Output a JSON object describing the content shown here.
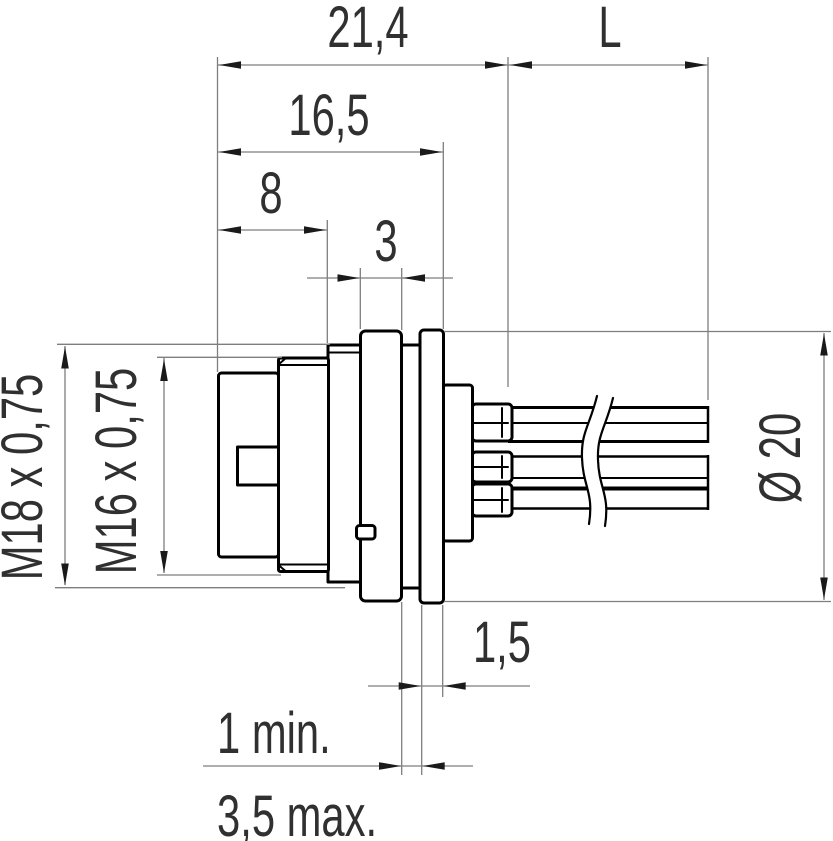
{
  "drawing_type": "connector-technical-drawing",
  "colors": {
    "background": "#ffffff",
    "part_outline": "#000000",
    "dimension_line": "#7e7e7e",
    "text": "#303030"
  },
  "dims": {
    "overall_depth": {
      "label": "21,4",
      "orientation": "horizontal"
    },
    "wire_length": {
      "label": "L",
      "orientation": "horizontal"
    },
    "front_depth": {
      "label": "16,5",
      "orientation": "horizontal"
    },
    "thread_depth": {
      "label": "8",
      "orientation": "horizontal"
    },
    "flange_thickness": {
      "label": "3",
      "orientation": "horizontal"
    },
    "disc_thickness": {
      "label": "1,5",
      "orientation": "horizontal"
    },
    "panel_min": {
      "label": "1 min.",
      "orientation": "horizontal"
    },
    "panel_max": {
      "label": "3,5 max.",
      "orientation": "horizontal"
    },
    "mounting_thread": {
      "label": "M18 x 0,75",
      "orientation": "vertical"
    },
    "locking_thread": {
      "label": "M16 x 0,75",
      "orientation": "vertical"
    },
    "flange_diameter": {
      "label": "Ø 20",
      "orientation": "vertical"
    }
  }
}
